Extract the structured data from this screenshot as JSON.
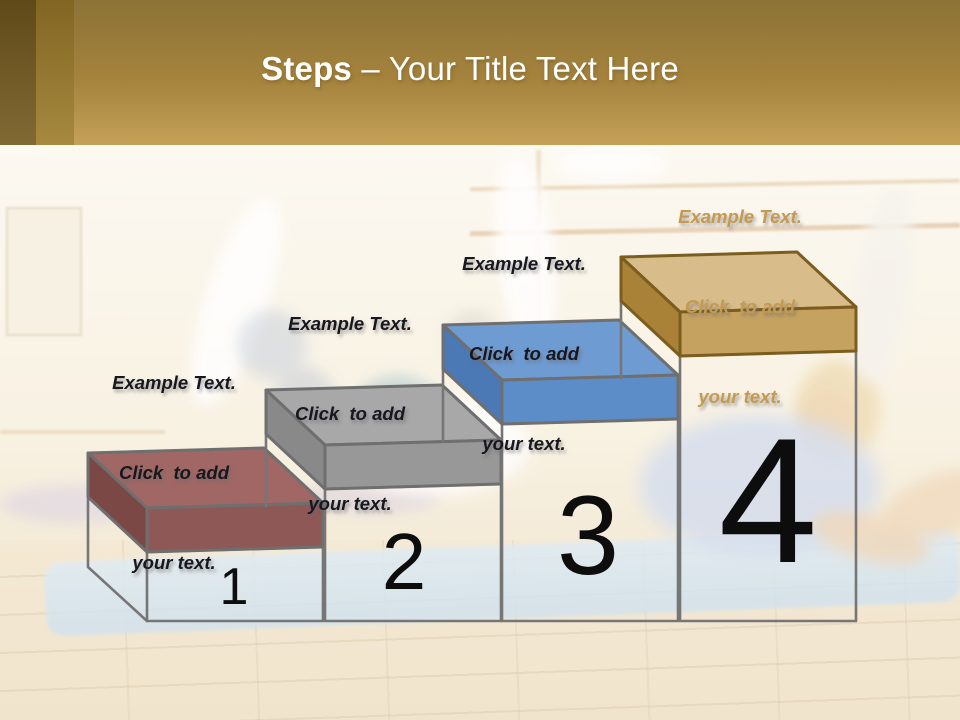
{
  "title": {
    "emphasis": "Steps",
    "separator": "–",
    "rest": "Your Title Text Here",
    "text_color": "#ffffff"
  },
  "theme": {
    "header_gold_top": "#8d7337",
    "header_gold_bottom": "#c5a158",
    "stripe_dark": "#6f571f",
    "stripe_medium": "#9a7b2c"
  },
  "wireframe": {
    "stroke": "#767676"
  },
  "numbers": {
    "color": "#0d0d0d"
  },
  "steps": [
    {
      "number": "1",
      "label": {
        "lines": [
          "Example Text.",
          "Click  to add",
          "your text."
        ],
        "color": "#17171f"
      },
      "box": {
        "top": "#a16765",
        "front": "#8e5856",
        "side": "#7c4846",
        "outline": "#6f6f6f"
      }
    },
    {
      "number": "2",
      "label": {
        "lines": [
          "Example Text.",
          "Click  to add",
          "your text."
        ],
        "color": "#17171f"
      },
      "box": {
        "top": "#a8a8a8",
        "front": "#989898",
        "side": "#898989",
        "outline": "#6f6f6f"
      }
    },
    {
      "number": "3",
      "label": {
        "lines": [
          "Example Text.",
          "Click  to add",
          "your text."
        ],
        "color": "#17171f"
      },
      "box": {
        "top": "#6f9bd3",
        "front": "#5d8dc9",
        "side": "#4b79b6",
        "outline": "#6f6f6f"
      }
    },
    {
      "number": "4",
      "label": {
        "lines": [
          "Example Text.",
          "Click  to add",
          "your text."
        ],
        "color": "#c49a50"
      },
      "box": {
        "top": "#d8bd8b",
        "front": "#c6a261",
        "side": "#a98137",
        "outline": "#7b5d1e"
      }
    }
  ]
}
